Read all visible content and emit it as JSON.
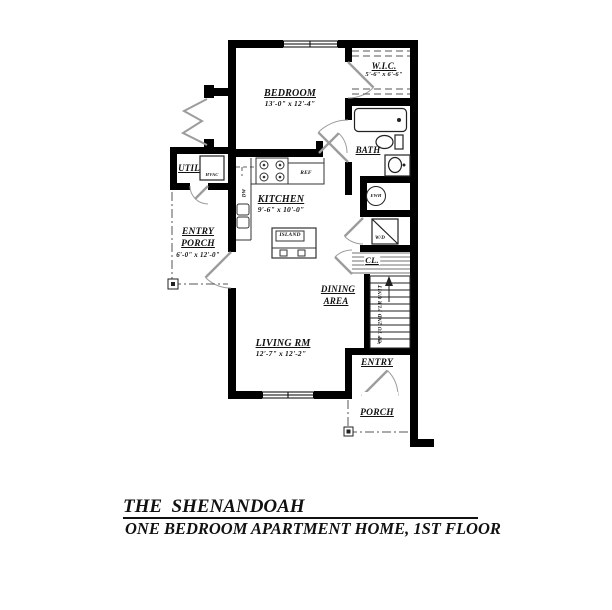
{
  "title_block": {
    "title": "THE  SHENANDOAH",
    "subtitle": "ONE BEDROOM APARTMENT HOME, 1ST FLOOR"
  },
  "rooms": {
    "bedroom": {
      "name": "BEDROOM",
      "dims": "13'-0\" x 12'-4\""
    },
    "wic": {
      "name": "W.I.C.",
      "dims": "5'-6\" x 6'-6\""
    },
    "bath": {
      "name": "BATH"
    },
    "util": {
      "name": "UTIL"
    },
    "kitchen": {
      "name": "KITCHEN",
      "dims": "9'-6\" x 10'-0\""
    },
    "entry_porch": {
      "line1": "ENTRY",
      "line2": "PORCH",
      "dims": "6'-0\" x 12'-0\""
    },
    "dining": {
      "line1": "DINING",
      "line2": "AREA"
    },
    "living": {
      "name": "LIVING RM",
      "dims": "12'-7\" x 12'-2\""
    },
    "closet": {
      "name": "CL."
    },
    "entry": {
      "name": "ENTRY"
    },
    "porch": {
      "name": "PORCH"
    }
  },
  "fixture_labels": {
    "hvac": "HVAC",
    "ref": "REF",
    "island": "ISLAND",
    "dw": "DW",
    "wd": "W/D",
    "ewh": "EWH",
    "stair_text": "UP TO 2ND FLR UNIT",
    "stair_number": "5"
  },
  "colors": {
    "wall": "#000000",
    "door_swing": "#9c9c9c",
    "background": "#ffffff"
  }
}
